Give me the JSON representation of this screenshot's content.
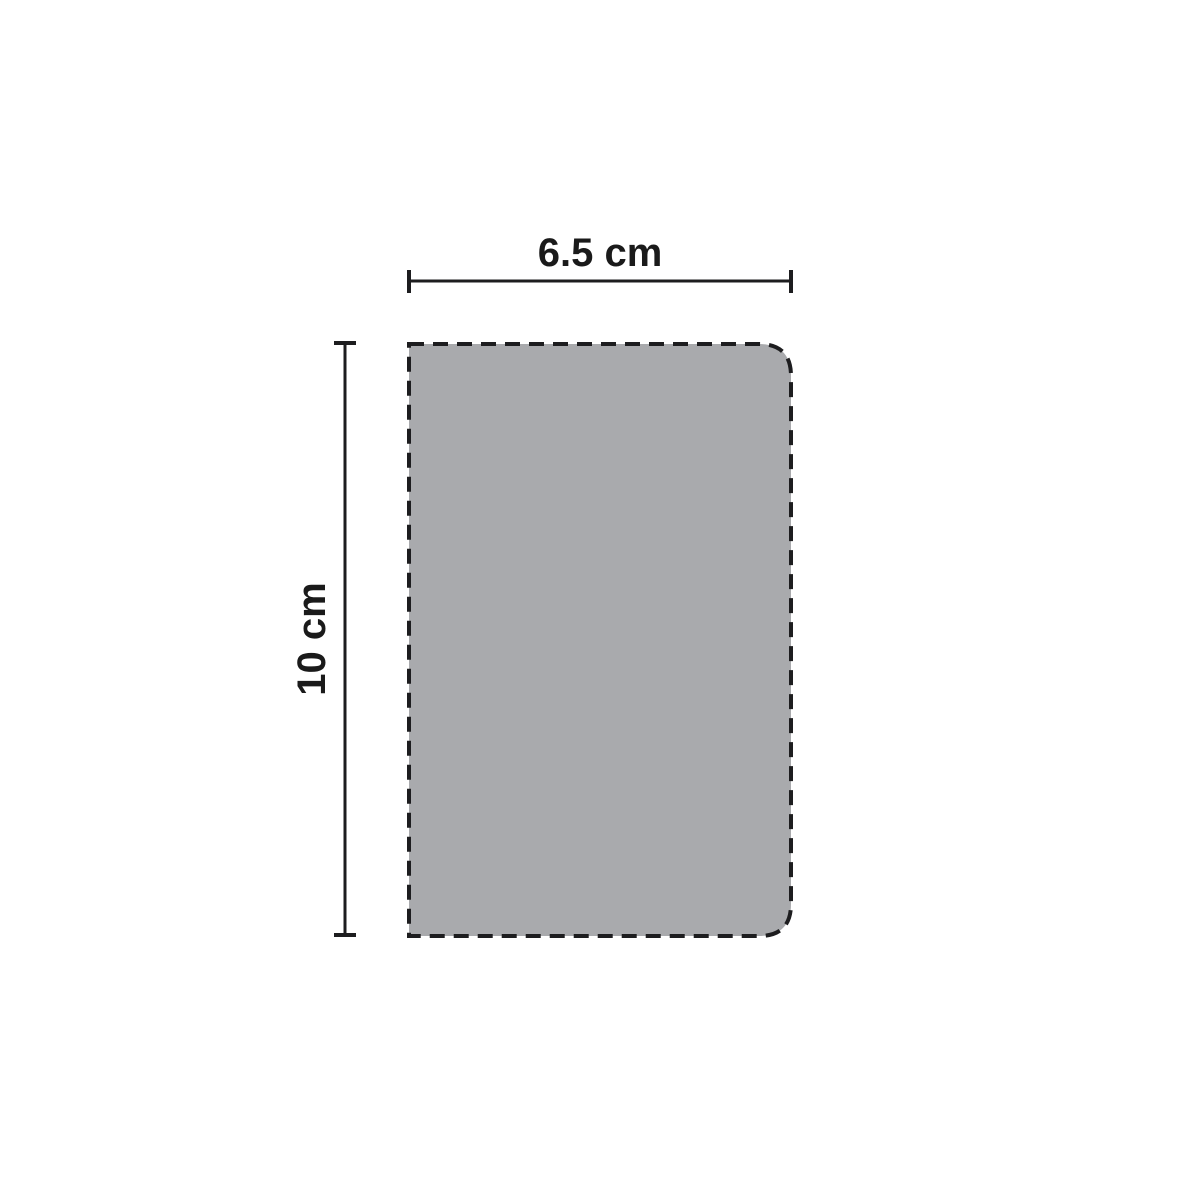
{
  "figure": {
    "description": "Rectangle with dashed outline, square left corners and rounded right corners, annotated with width and height dimensions",
    "width_label": "6.5 cm",
    "height_label": "10 cm",
    "shape_fill": "#A9AAAD",
    "outline_color": "#1D1D1F",
    "dimension_line_color": "#1D1D1F",
    "label_color": "#1A1A1A"
  }
}
